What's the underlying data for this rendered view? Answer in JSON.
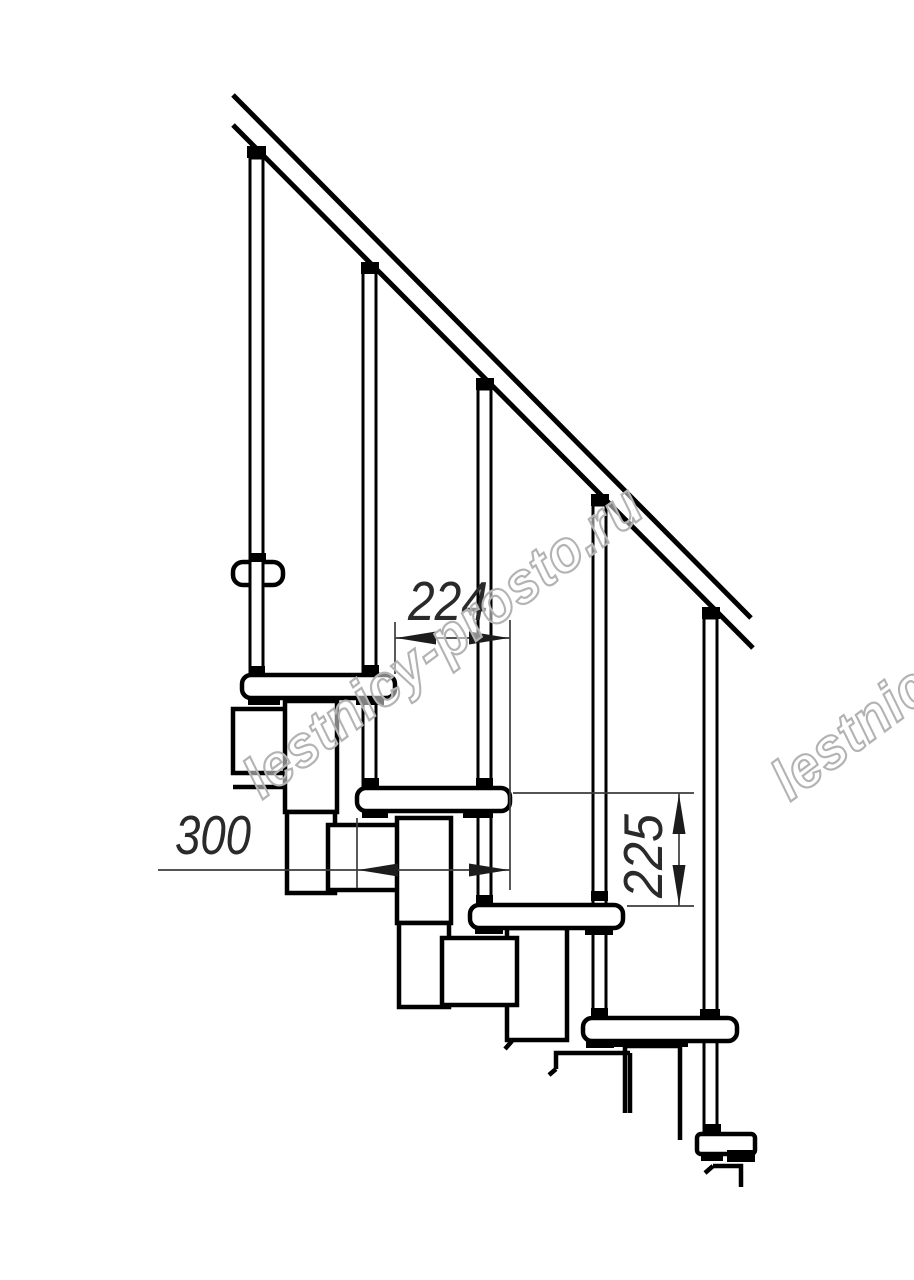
{
  "drawing": {
    "title": "Modular staircase side-view technical drawing",
    "background": "#ffffff",
    "line_color": "#000000",
    "dimension_color": "#2a2a2a",
    "watermark": {
      "text": "lestnicy-prosto.ru",
      "color": "#b3b3b3",
      "angle_deg": -36.6
    },
    "dimensions": {
      "going": {
        "label": "224",
        "value": 224,
        "unit": "mm",
        "orientation": "horizontal"
      },
      "tread_depth": {
        "label": "300",
        "value": 300,
        "unit": "mm",
        "orientation": "horizontal"
      },
      "rise": {
        "label": "225",
        "value": 225,
        "unit": "mm",
        "orientation": "vertical"
      }
    },
    "components": {
      "handrail_count": 1,
      "baluster_count": 5,
      "tread_count": 4,
      "base_support_count": 1
    }
  }
}
